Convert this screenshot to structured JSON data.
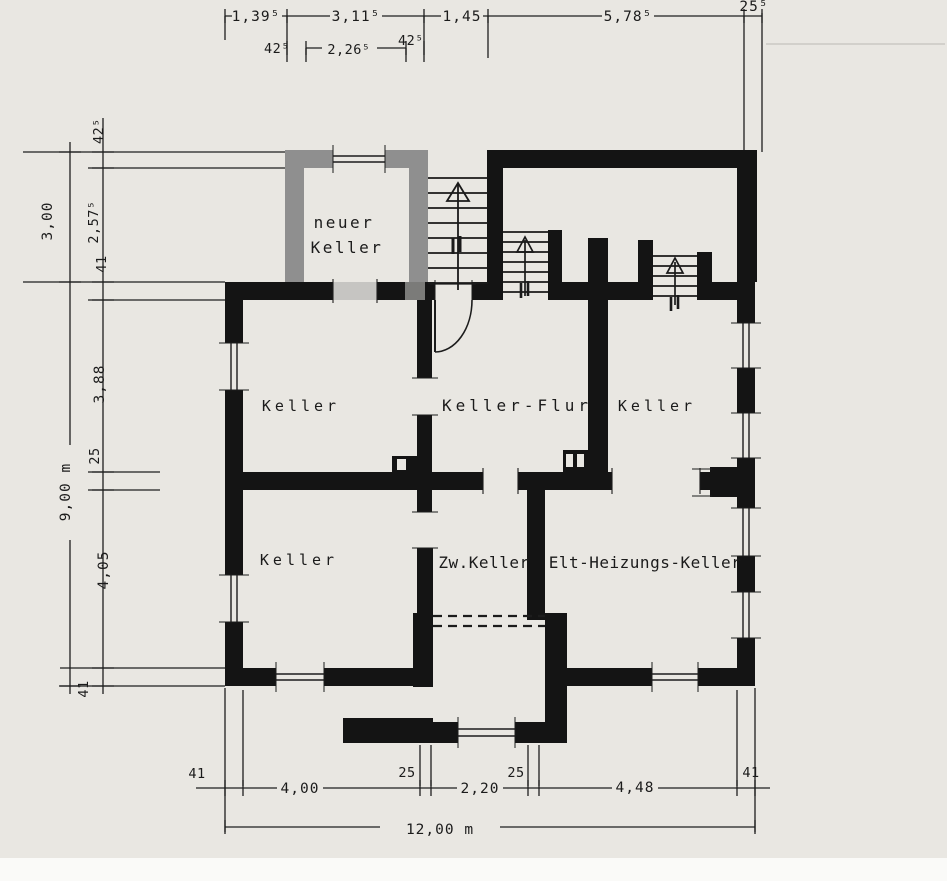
{
  "drawing": {
    "rooms": {
      "neuer_keller_line1": "neuer",
      "neuer_keller_line2": "Keller",
      "keller_nw": "Keller",
      "keller_flur": "Keller-Flur",
      "keller_ne": "Keller",
      "keller_sw": "Keller",
      "zw_keller": "Zw.Keller",
      "elt_heizungs_keller": "Elt-Heizungs-Keller"
    },
    "dims": {
      "top1_1": "1,39⁵",
      "top1_2": "3,11⁵",
      "top1_3": "1,45",
      "top1_4": "5,78⁵",
      "top1_5": "25⁵",
      "top2_1": "42⁵",
      "top2_2": "2,26⁵",
      "top2_3": "42⁵",
      "left_out_1": "3,00",
      "left_out_2": "9,00 m",
      "left_in_1": "42⁵",
      "left_in_2": "2,57⁵",
      "left_in_3": "41",
      "left_in_4": "3,88",
      "left_in_5": "25",
      "left_in_6": "4,05",
      "left_in_7": "41",
      "bot_1": "41",
      "bot_2": "4,00",
      "bot_3": "25",
      "bot_4": "2,20",
      "bot_5": "25",
      "bot_6": "4,48",
      "bot_7": "41",
      "bot_total": "12,00 m"
    },
    "colors": {
      "paper": "#e9e7e2",
      "wall_black": "#141414",
      "wall_new_gray": "#8f8f8f",
      "infill_light": "#c6c5c2",
      "infill_dark": "#7b7b79",
      "line": "#1f1f1f"
    }
  }
}
